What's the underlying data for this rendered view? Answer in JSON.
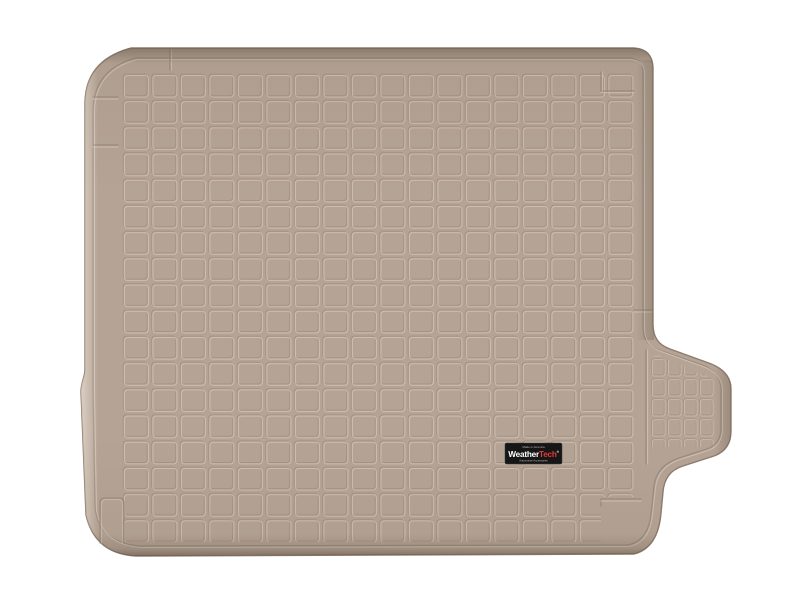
{
  "image": {
    "description": "Top-down product photo of a tan molded cargo/trunk liner mat with a raised perimeter lip, embossed square grid pattern, a contoured bump-out on the right edge, and a WeatherTech logo badge near the lower right",
    "background_color": "#ffffff"
  },
  "mat": {
    "color_name": "Tan",
    "base_color": "#b5a496",
    "groove_shadow": "#9f8e7d",
    "groove_highlight": "#d6c8b8",
    "edge_color": "#8d7c6c"
  },
  "badge": {
    "top_text": "Made in America",
    "brand_weather": "Weather",
    "brand_tech": "Tech",
    "registered_mark": "®",
    "bottom_text": "Automotive Accessories",
    "background": "#161616",
    "weather_color": "#ffffff",
    "tech_color": "#e03c35",
    "small_text_color": "#b9b4ae"
  }
}
